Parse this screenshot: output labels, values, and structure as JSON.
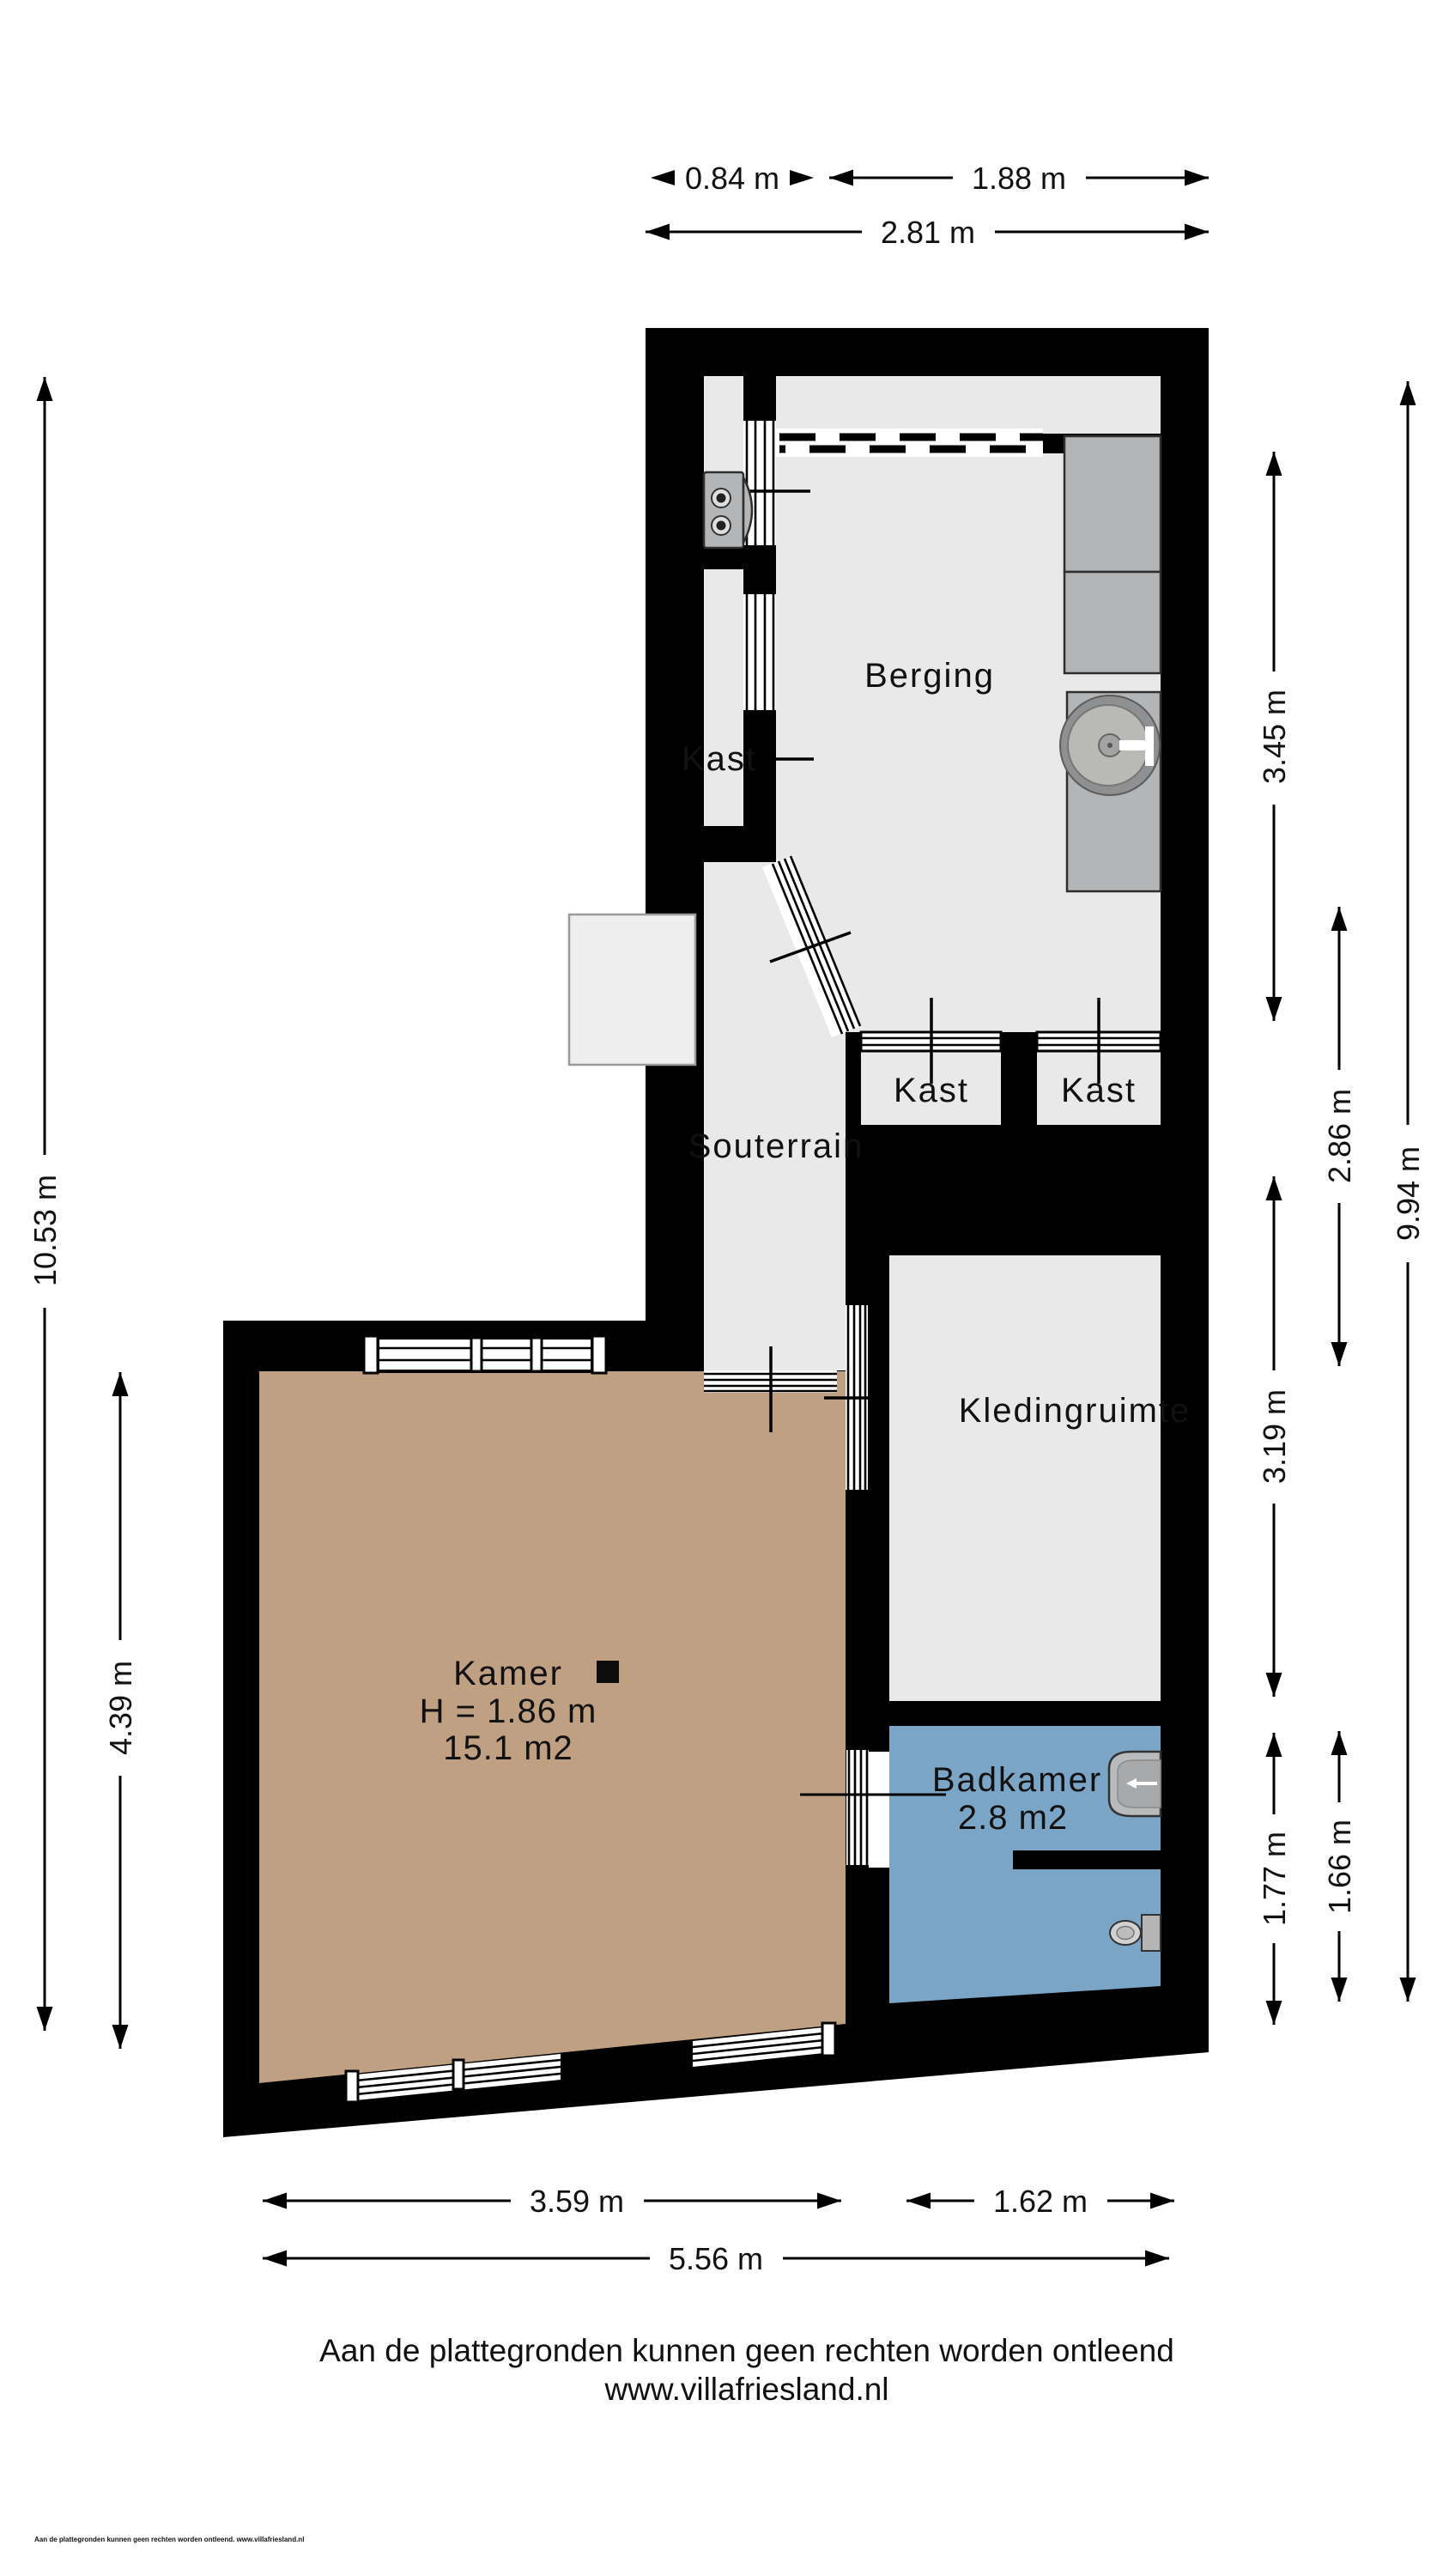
{
  "colors": {
    "wall": "#000000",
    "room": "#e9e9e9",
    "kamer": "#c0a083",
    "badkamer": "#7ba5c6",
    "furniture": "#b4b5b7",
    "stairs": "#eeeeee",
    "text": "#111111"
  },
  "rooms": {
    "berging": {
      "label": "Berging"
    },
    "kast_upper": {
      "label": "Kast"
    },
    "kast_closet_left": {
      "label": "Kast"
    },
    "kast_closet_right": {
      "label": "Kast"
    },
    "souterrain": {
      "label": "Souterrain"
    },
    "kledingruimte": {
      "label": "Kledingruimte"
    },
    "kamer": {
      "label": "Kamer",
      "ceiling_height": "H = 1.86 m",
      "area": "15.1 m2"
    },
    "badkamer": {
      "label": "Badkamer",
      "area": "2.8 m2"
    }
  },
  "dimensions": {
    "top": [
      {
        "label": "0.84 m"
      },
      {
        "label": "1.88 m"
      },
      {
        "label": "2.81 m"
      }
    ],
    "left": [
      {
        "label": "10.53 m"
      },
      {
        "label": "4.39 m"
      }
    ],
    "right": [
      {
        "label": "3.45 m"
      },
      {
        "label": "2.86 m"
      },
      {
        "label": "9.94 m"
      },
      {
        "label": "3.19 m"
      },
      {
        "label": "1.77 m"
      },
      {
        "label": "1.66 m"
      }
    ],
    "bottom": [
      {
        "label": "3.59 m"
      },
      {
        "label": "1.62 m"
      },
      {
        "label": "5.56 m"
      }
    ]
  },
  "footer": {
    "disclaimer": "Aan de plattegronden kunnen geen rechten worden ontleend",
    "website": "www.villafriesland.nl",
    "small_print": "Aan de plattegronden kunnen geen rechten worden ontleend. www.villafriesland.nl"
  }
}
